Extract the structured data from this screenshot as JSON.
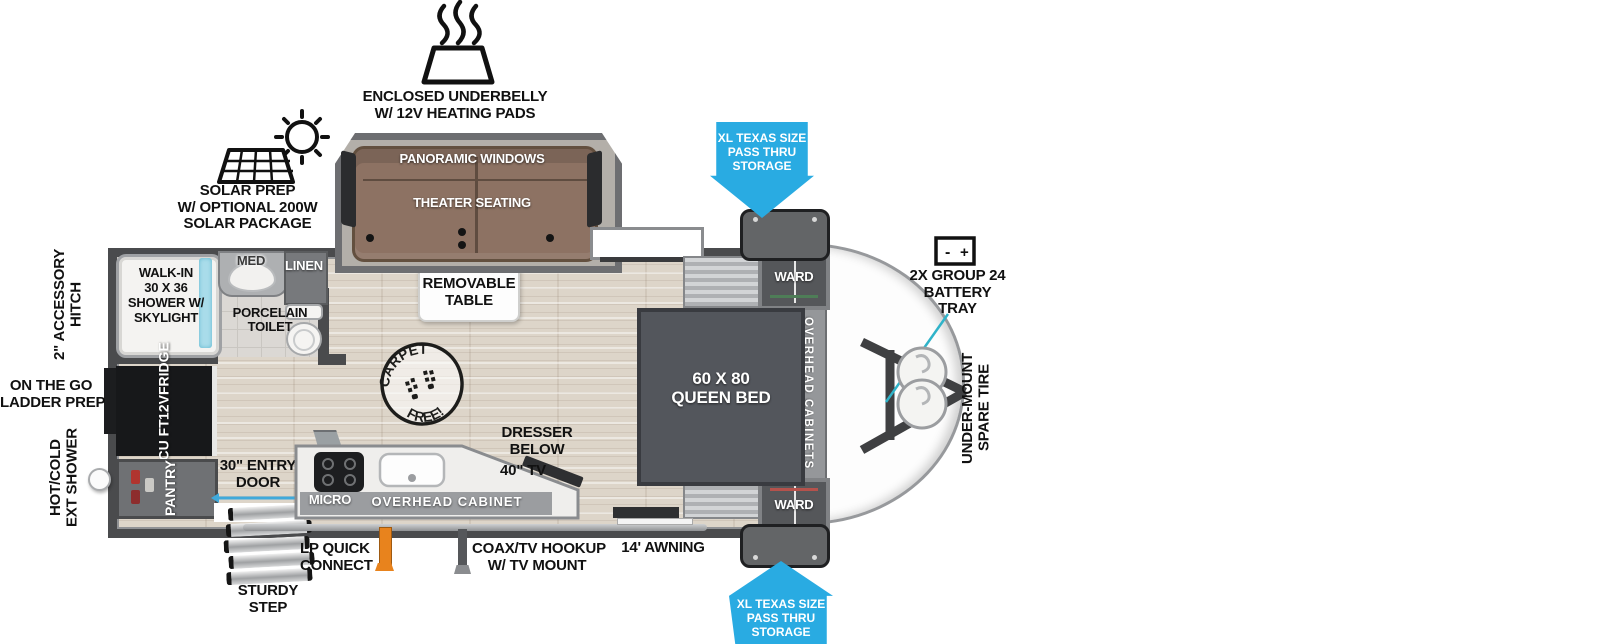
{
  "exterior": {
    "underbelly": [
      "ENCLOSED UNDERBELLY",
      "W/ 12V HEATING PADS"
    ],
    "solar": [
      "SOLAR PREP",
      "W/ OPTIONAL 200W",
      "SOLAR PACKAGE"
    ],
    "pass_thru": [
      "XL TEXAS SIZE",
      "PASS THRU",
      "STORAGE"
    ],
    "battery": [
      "2X GROUP 24",
      "BATTERY",
      "TRAY"
    ],
    "battery_icon": {
      "minus": "-",
      "plus": "+"
    },
    "spare_tire": [
      "UNDER-MOUNT",
      "SPARE TIRE"
    ],
    "hitch": [
      "2\" ACCESSORY",
      "HITCH"
    ],
    "ladder": [
      "ON THE GO",
      "LADDER PREP"
    ],
    "ext_shower": [
      "HOT/COLD",
      "EXT SHOWER"
    ],
    "lp": [
      "LP QUICK",
      "CONNECT"
    ],
    "coax": [
      "COAX/TV HOOKUP",
      "W/ TV MOUNT"
    ],
    "awning": "14' AWNING",
    "step": [
      "STURDY",
      "STEP"
    ],
    "entry": [
      "30\" ENTRY",
      "DOOR"
    ]
  },
  "interior": {
    "slide": {
      "windows": "PANORAMIC WINDOWS",
      "seating": "THEATER SEATING"
    },
    "table": [
      "REMOVABLE",
      "TABLE"
    ],
    "stamp": {
      "top": "CARPET",
      "bottom": "FREE!"
    },
    "bath": {
      "shower": [
        "WALK-IN",
        "30 X 36",
        "SHOWER W/",
        "SKYLIGHT"
      ],
      "med": "MED",
      "linen": "LINEN",
      "toilet": [
        "PORCELAIN",
        "TOILET"
      ]
    },
    "kitchen": {
      "fridge": [
        "10 CU FT",
        "12V",
        "FRIDGE"
      ],
      "pantry": "PANTRY",
      "micro": "MICRO",
      "overhead": "OVERHEAD CABINET",
      "tv": "40\" TV",
      "dresser": [
        "DRESSER",
        "BELOW"
      ]
    },
    "bedroom": {
      "bed": [
        "60 X 80",
        "QUEEN BED"
      ],
      "ward": "WARD",
      "overhead": "OVERHEAD CABINETS"
    }
  },
  "colors": {
    "arrow_blue": "#29abe2",
    "pointer_teal": "#2fb3c9",
    "shower_glass": "#a9dcea",
    "lp_orange": "#e8831d",
    "sofa_brown": "#8d7263",
    "bed_gray": "#53565c"
  }
}
